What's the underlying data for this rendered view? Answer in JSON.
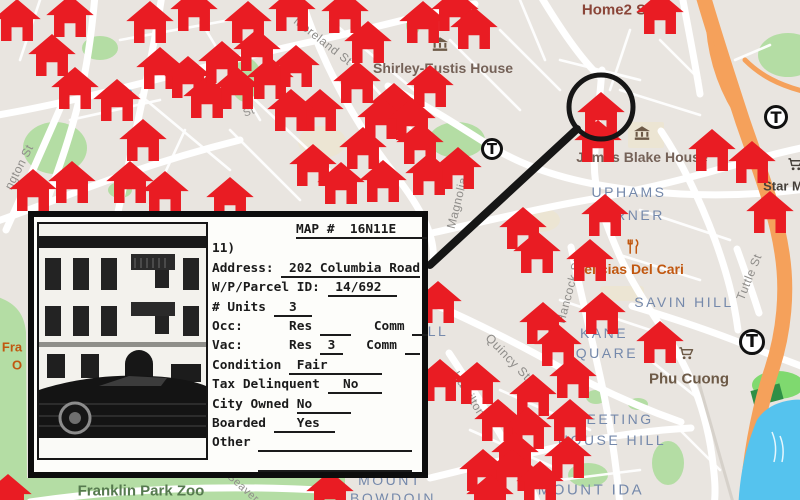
{
  "colors": {
    "bg": "#e9e5e0",
    "house": "#e91c23",
    "annotation": "#161616",
    "place": "#7589ab",
    "street": "#8f8d8a",
    "poi-brown": "#756258",
    "poi-food": "#c1570f",
    "poi-shop": "#6d5a47",
    "poi-dark": "#46403a",
    "poi-lodging": "#8a4538",
    "park-label": "#567a4f",
    "water": "#55c3ee",
    "park": "#b4dda4",
    "park-bright": "#7fd96f",
    "park-dark": "#2f8f46",
    "highway": "#f5a15b",
    "road": "#ffffff",
    "beige": "#ece5d3"
  },
  "map": {
    "transit_label": "T",
    "transit_stations": [
      {
        "x": 492,
        "y": 149,
        "r": 11
      },
      {
        "x": 776,
        "y": 117,
        "r": 12
      },
      {
        "x": 752,
        "y": 342,
        "r": 13
      }
    ],
    "labels": [
      {
        "text": "Home2 S",
        "x": 614,
        "y": 10,
        "cls": "lab-lodging",
        "size": 15
      },
      {
        "text": "Shirley-Eustis House",
        "x": 443,
        "y": 68,
        "cls": "lab-museum",
        "size": 14
      },
      {
        "text": "James Blake House",
        "x": 642,
        "y": 157,
        "cls": "lab-museum",
        "size": 14
      },
      {
        "text": "UPHAMS",
        "x": 629,
        "y": 192,
        "cls": "lab-place",
        "size": 14
      },
      {
        "text": "CORNER",
        "x": 627,
        "y": 215,
        "cls": "lab-place",
        "size": 14
      },
      {
        "text": "SAVIN HILL",
        "x": 684,
        "y": 302,
        "cls": "lab-place",
        "size": 14
      },
      {
        "text": "KANE",
        "x": 604,
        "y": 333,
        "cls": "lab-place",
        "size": 14
      },
      {
        "text": "SQUARE",
        "x": 601,
        "y": 353,
        "cls": "lab-place",
        "size": 14
      },
      {
        "text": "MEETING",
        "x": 613,
        "y": 419,
        "cls": "lab-place",
        "size": 14
      },
      {
        "text": "HOUSE HILL",
        "x": 612,
        "y": 440,
        "cls": "lab-place",
        "size": 14
      },
      {
        "text": "MOUNT IDA",
        "x": 591,
        "y": 490,
        "cls": "lab-place",
        "size": 15
      },
      {
        "text": "MOUNT",
        "x": 390,
        "y": 480,
        "cls": "lab-place",
        "size": 14
      },
      {
        "text": "BOWDOIN",
        "x": 393,
        "y": 498,
        "cls": "lab-place",
        "size": 14
      },
      {
        "text": "LL",
        "x": 438,
        "y": 331,
        "cls": "lab-place",
        "size": 14
      },
      {
        "text": "Delicias Del Cari",
        "x": 629,
        "y": 269,
        "cls": "lab-food",
        "size": 14
      },
      {
        "text": "Phu Cuong",
        "x": 689,
        "y": 379,
        "cls": "lab-shop",
        "size": 15
      },
      {
        "text": "Star M",
        "x": 783,
        "y": 186,
        "cls": "lab-dark",
        "size": 13
      },
      {
        "text": "Franklin Park Zoo",
        "x": 141,
        "y": 491,
        "cls": "lab-park",
        "size": 15
      },
      {
        "text": "Fra",
        "x": 12,
        "y": 347,
        "cls": "lab-food",
        "size": 13
      },
      {
        "text": "O",
        "x": 17,
        "y": 365,
        "cls": "lab-food",
        "size": 13
      },
      {
        "text": "Moreland St",
        "x": 323,
        "y": 41,
        "cls": "lab-street",
        "size": 12,
        "rot": 38
      },
      {
        "text": "ngton St",
        "x": 19,
        "y": 167,
        "cls": "lab-street",
        "size": 12,
        "rot": -63
      },
      {
        "text": "Magnolia St",
        "x": 459,
        "y": 195,
        "cls": "lab-street",
        "size": 12,
        "rot": -76
      },
      {
        "text": "Hancock St",
        "x": 569,
        "y": 291,
        "cls": "lab-street",
        "size": 12,
        "rot": -75
      },
      {
        "text": "Quincy St",
        "x": 508,
        "y": 357,
        "cls": "lab-street",
        "size": 12.5,
        "rot": 46
      },
      {
        "text": "Hamilton",
        "x": 469,
        "y": 394,
        "cls": "lab-street",
        "size": 12,
        "rot": 58
      },
      {
        "text": "Tuttle St",
        "x": 749,
        "y": 277,
        "cls": "lab-street",
        "size": 12,
        "rot": -68
      },
      {
        "text": "Seaver",
        "x": 243,
        "y": 488,
        "cls": "lab-street",
        "size": 11,
        "rot": 42
      },
      {
        "text": "St",
        "x": 249,
        "y": 112,
        "cls": "lab-street",
        "size": 11,
        "rot": -20
      }
    ],
    "poi_icons": [
      {
        "type": "museum",
        "x": 440,
        "y": 47,
        "size": 16,
        "color": "#6d5a47"
      },
      {
        "type": "museum",
        "x": 642,
        "y": 136,
        "size": 16,
        "color": "#6d5a47"
      },
      {
        "type": "restaurant",
        "x": 633,
        "y": 249,
        "size": 15,
        "color": "#c1570f"
      },
      {
        "type": "cart",
        "x": 686,
        "y": 356,
        "size": 15,
        "color": "#6d5a47"
      },
      {
        "type": "cart",
        "x": 795,
        "y": 167,
        "size": 15,
        "color": "#46403a"
      }
    ],
    "houses": [
      [
        17,
        20
      ],
      [
        70,
        16
      ],
      [
        150,
        22
      ],
      [
        194,
        10
      ],
      [
        248,
        22
      ],
      [
        52,
        55
      ],
      [
        75,
        88
      ],
      [
        117,
        100
      ],
      [
        160,
        68
      ],
      [
        188,
        77
      ],
      [
        207,
        97
      ],
      [
        222,
        62
      ],
      [
        237,
        88
      ],
      [
        257,
        50
      ],
      [
        270,
        78
      ],
      [
        143,
        140
      ],
      [
        33,
        190
      ],
      [
        72,
        182
      ],
      [
        130,
        182
      ],
      [
        165,
        192
      ],
      [
        230,
        198
      ],
      [
        292,
        10
      ],
      [
        345,
        12
      ],
      [
        368,
        42
      ],
      [
        423,
        22
      ],
      [
        455,
        10
      ],
      [
        474,
        28
      ],
      [
        296,
        66
      ],
      [
        357,
        82
      ],
      [
        394,
        104
      ],
      [
        430,
        86
      ],
      [
        381,
        118
      ],
      [
        412,
        119
      ],
      [
        320,
        110
      ],
      [
        291,
        110
      ],
      [
        363,
        148
      ],
      [
        420,
        143
      ],
      [
        313,
        165
      ],
      [
        341,
        183
      ],
      [
        383,
        181
      ],
      [
        429,
        174
      ],
      [
        458,
        168
      ],
      [
        660,
        13
      ],
      [
        601,
        113
      ],
      [
        598,
        141
      ],
      [
        712,
        150
      ],
      [
        752,
        162
      ],
      [
        523,
        228
      ],
      [
        537,
        252
      ],
      [
        590,
        260
      ],
      [
        605,
        215
      ],
      [
        770,
        212
      ],
      [
        438,
        302
      ],
      [
        543,
        323
      ],
      [
        602,
        313
      ],
      [
        660,
        342
      ],
      [
        558,
        345
      ],
      [
        573,
        377
      ],
      [
        440,
        380
      ],
      [
        477,
        383
      ],
      [
        533,
        395
      ],
      [
        498,
        420
      ],
      [
        528,
        428
      ],
      [
        570,
        420
      ],
      [
        515,
        453
      ],
      [
        483,
        470
      ],
      [
        512,
        470
      ],
      [
        568,
        457
      ],
      [
        540,
        482
      ],
      [
        490,
        495
      ],
      [
        330,
        492
      ],
      [
        8,
        495
      ]
    ]
  },
  "annotation": {
    "circle": {
      "x": 601,
      "y": 107,
      "r": 32,
      "stroke": 5
    },
    "line": {
      "x1": 577,
      "y1": 129,
      "x2": 430,
      "y2": 265,
      "stroke": 8
    }
  },
  "card": {
    "lines": [
      {
        "indent": true,
        "segs": [
          {
            "t": "MAP #  16N11E    ",
            "u": 1
          }
        ]
      },
      {
        "indent": false,
        "segs": [
          {
            "t": "11)",
            "u": 0
          }
        ]
      },
      {
        "indent": false,
        "segs": [
          {
            "t": "Address: ",
            "u": 0
          },
          {
            "t": " 202 Columbia Road",
            "u": 1
          }
        ]
      },
      {
        "indent": false,
        "segs": [
          {
            "t": "W/P/Parcel ID: ",
            "u": 0
          },
          {
            "t": " 14/692  ",
            "u": 1
          }
        ]
      },
      {
        "indent": false,
        "segs": [
          {
            "t": "# Units ",
            "u": 0
          },
          {
            "t": "  3  ",
            "u": 1
          }
        ]
      },
      {
        "indent": false,
        "segs": [
          {
            "t": "Occ:      Res ",
            "u": 0
          },
          {
            "t": "    ",
            "u": 1
          },
          {
            "t": "   Comm ",
            "u": 0
          },
          {
            "t": "  ",
            "u": 1
          }
        ]
      },
      {
        "indent": false,
        "segs": [
          {
            "t": "Vac:      Res ",
            "u": 0
          },
          {
            "t": " 3 ",
            "u": 1
          },
          {
            "t": "   Comm ",
            "u": 0
          },
          {
            "t": "  ",
            "u": 1
          }
        ]
      },
      {
        "indent": false,
        "segs": [
          {
            "t": "Condition ",
            "u": 0
          },
          {
            "t": " Fair       ",
            "u": 1
          }
        ]
      },
      {
        "indent": false,
        "segs": [
          {
            "t": "Tax Delinquent ",
            "u": 0
          },
          {
            "t": "  No   ",
            "u": 1
          }
        ]
      },
      {
        "indent": false,
        "segs": [
          {
            "t": "City Owned ",
            "u": 0
          },
          {
            "t": "No     ",
            "u": 1
          }
        ]
      },
      {
        "indent": false,
        "segs": [
          {
            "t": "Boarded ",
            "u": 0
          },
          {
            "t": "   Yes  ",
            "u": 1
          }
        ]
      },
      {
        "indent": false,
        "segs": [
          {
            "t": "Other ",
            "u": 0
          },
          {
            "t": "                    ",
            "u": 1
          }
        ]
      },
      {
        "indent": false,
        "segs": [
          {
            "t": "      ",
            "u": 0
          },
          {
            "t": "                    ",
            "u": 1
          }
        ]
      }
    ]
  }
}
